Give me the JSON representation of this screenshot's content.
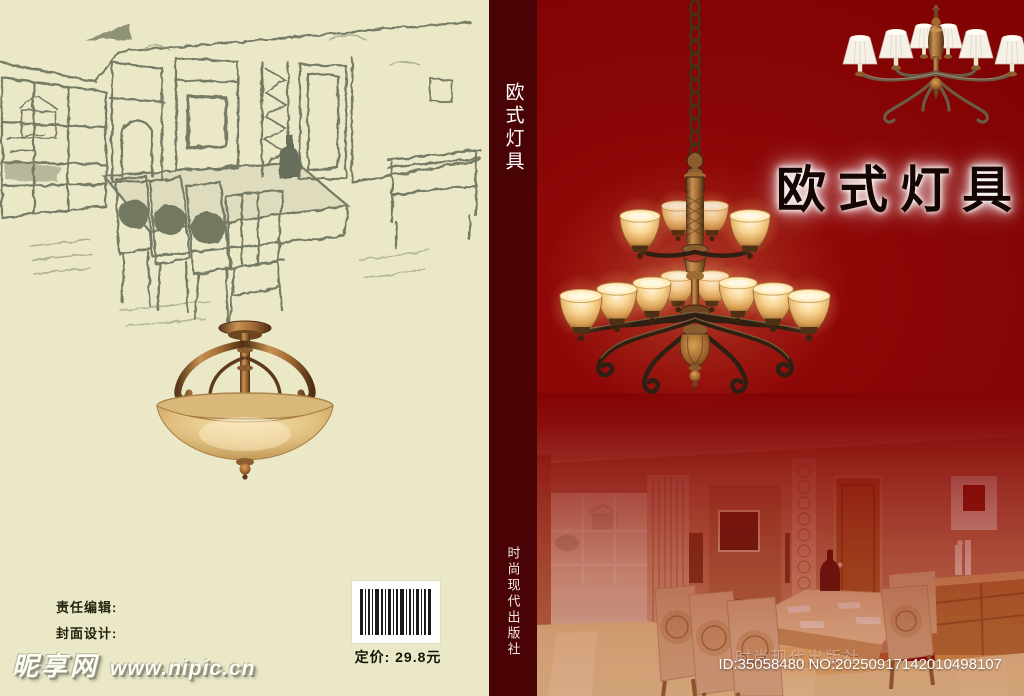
{
  "document": {
    "kind_label": "book cover design"
  },
  "back_cover": {
    "credits": {
      "editor_label": "责任编辑:",
      "designer_label": "封面设计:"
    },
    "price_text": "定价: 29.8元",
    "images": {
      "sketch": "dining-room-pencil-sketch",
      "lamp": "alabaster-bowl-ceiling-lamp"
    }
  },
  "spine": {
    "title": "欧式灯具",
    "publisher": "时尚现代出版社"
  },
  "front_cover": {
    "title": "欧式灯具",
    "publisher_watermark": "时尚现代出版社",
    "images": {
      "main_chandelier": "twelve-light-amber-glass-chandelier",
      "small_chandelier": "six-light-white-shade-chandelier",
      "photo": "modern-dining-room-interior-photo"
    }
  },
  "watermarks": {
    "site_name": "昵享网",
    "site_url": "www.nipic.cn",
    "id_text": "ID:35058480 NO:20250917142010498107"
  },
  "colors": {
    "back_cover_bg": "#ebe8c8",
    "spine_bg": "#4a0305",
    "front_cover_bg": "#870606",
    "title_color": "#150603",
    "title_glow": "#ffffff",
    "shade_glow": "#ffdD96"
  }
}
